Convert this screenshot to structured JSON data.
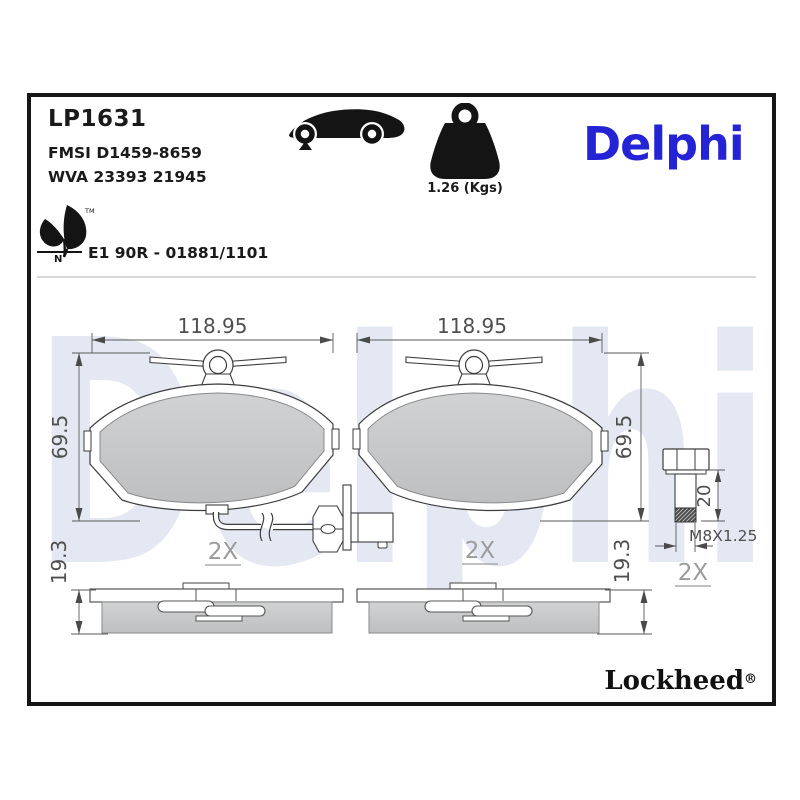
{
  "header": {
    "part_number": "LP1631",
    "fmsi": "FMSI D1459-8659",
    "wva": "WVA 23393 21945",
    "weight": "1.26 (Kgs)",
    "brand": "Delphi",
    "approval": "E1 90R - 01881/1101",
    "leaf_trademark": "TM",
    "leaf_letter": "N"
  },
  "drawing": {
    "watermark": "Delphi",
    "pad_width": "118.95",
    "pad_height": "69.5",
    "pad_thickness": "19.3",
    "quantity": "2X",
    "bolt_length": "20",
    "bolt_thread_spec": "M8X1.25"
  },
  "footer": {
    "brand": "Lockheed",
    "registered": "®"
  },
  "colors": {
    "brand_blue": "#2424d6",
    "watermark_blue": "#e3e8f2",
    "friction_gray": "#c7c9ca",
    "frame_black": "#161616"
  }
}
